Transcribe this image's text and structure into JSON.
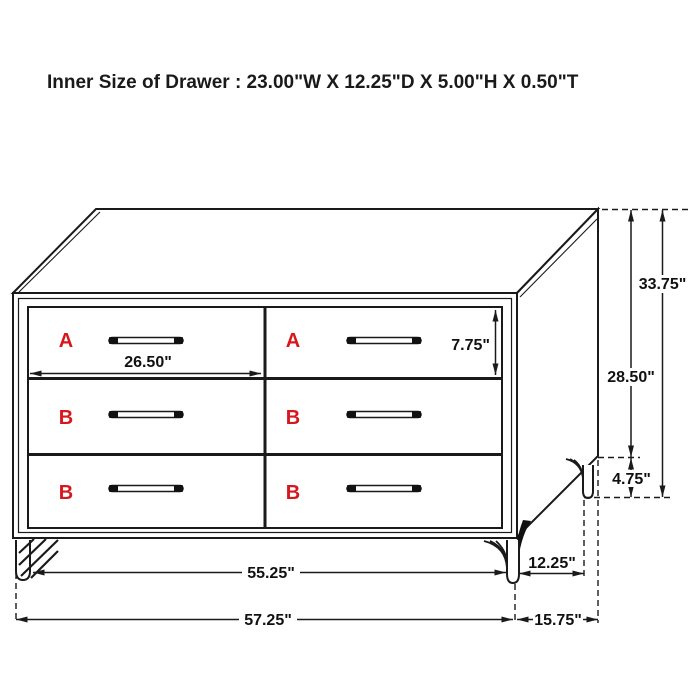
{
  "header": {
    "title": "Inner Size of Drawer : 23.00\"W X 12.25\"D X 5.00\"H X 0.50\"T"
  },
  "drawers": {
    "left": [
      "A",
      "B",
      "B"
    ],
    "right": [
      "A",
      "B",
      "B"
    ]
  },
  "dims": {
    "drawer_opening_width": "26.50\"",
    "drawer_front_height": "7.75\"",
    "overall_height": "33.75\"",
    "case_height": "28.50\"",
    "leg_height": "4.75\"",
    "front_width_between_legs": "55.25\"",
    "overall_width": "57.25\"",
    "depth_between_legs": "12.25\"",
    "overall_depth": "15.75\""
  },
  "colors": {
    "label_red": "#d6181e",
    "line": "#1a1a1a",
    "background": "#ffffff"
  }
}
